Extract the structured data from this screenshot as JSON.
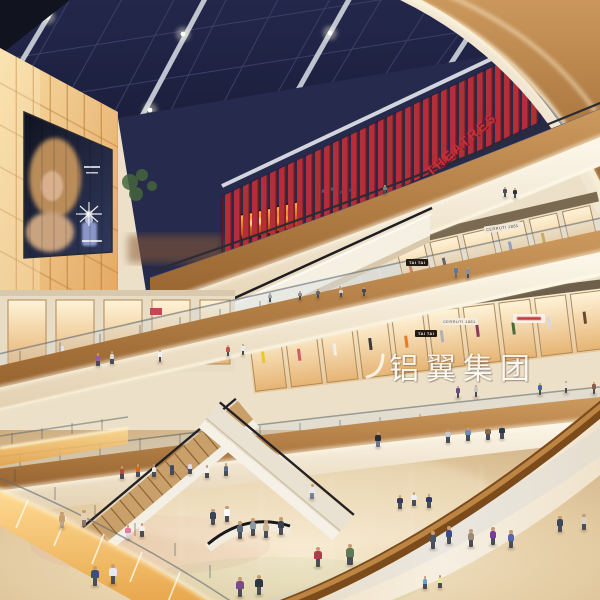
{
  "scene": {
    "description": "Rendering of a multi-level shopping mall atrium: dark skylight grid ceiling, glowing amber light-box wall with perfume billboard, curved cream and wood balconies, red-slat cinema level, escalators, crowded beige marble ground floor",
    "signs": {
      "theatres": "THEATRES",
      "watermark": "铝翼集团",
      "store_cerruti_upper": "CERRUTI 1881",
      "store_cerruti_lower": "CERRUTI 1881",
      "store_taitai_upper": "TAI TAI",
      "store_taitai_lower": "TAI TAI"
    },
    "colors": {
      "ceiling_navy": "#1d2142",
      "beam_white": "#d5dae3",
      "slat_red": "#b22e38",
      "theatres_red": "#c5303c",
      "lightbox_amber": "#f0c080",
      "wood_brown": "#b9854f",
      "cream_white": "#f4ecdd",
      "floor_beige": "#e6d2ab",
      "fire_orange": "#e06a18",
      "handrail_brown": "#9a6428",
      "glass_navy": "#262a4c",
      "tree_green": "#44663c",
      "watermark_white": "#ffffff"
    },
    "people": [
      [
        505,
        197,
        10,
        "#4a4e5e"
      ],
      [
        515,
        198,
        10,
        "#2e3240"
      ],
      [
        385,
        194,
        9,
        "#7a7e8a"
      ],
      [
        270,
        302,
        9,
        "#9aa4ae"
      ],
      [
        300,
        300,
        9,
        "#8a8e9a"
      ],
      [
        318,
        298,
        9,
        "#5a6a7a"
      ],
      [
        341,
        297,
        9,
        "#d0d0d6"
      ],
      [
        364,
        296,
        9,
        "#39495a"
      ],
      [
        456,
        277,
        11,
        "#5a7a9a",
        "#6a7078"
      ],
      [
        468,
        278,
        11,
        "#8090a0"
      ],
      [
        458,
        398,
        12,
        "#6a4a8a"
      ],
      [
        476,
        397,
        12,
        "#c4c6cc"
      ],
      [
        540,
        395,
        12,
        "#46689a"
      ],
      [
        566,
        393,
        12,
        "#e6dfd2"
      ],
      [
        594,
        394,
        12,
        "#8a5a4a"
      ],
      [
        98,
        366,
        13,
        "#9a5aa8"
      ],
      [
        112,
        364,
        13,
        "#d8d8e0"
      ],
      [
        160,
        362,
        12,
        "#f0f0f4"
      ],
      [
        228,
        356,
        11,
        "#c05848"
      ],
      [
        243,
        355,
        11,
        "#e8e8ee"
      ],
      [
        122,
        479,
        13,
        "#b04a3a"
      ],
      [
        138,
        477,
        13,
        "#d2691e"
      ],
      [
        154,
        477,
        13,
        "#e8e8e8"
      ],
      [
        172,
        475,
        13,
        "#3a4a6a"
      ],
      [
        190,
        474,
        13,
        "#dcdce4"
      ],
      [
        207,
        478,
        13,
        "#f4f4f6"
      ],
      [
        226,
        476,
        13,
        "#5a6a8c"
      ],
      [
        62,
        528,
        16,
        "#c8a070",
        "#b8a890"
      ],
      [
        84,
        526,
        16,
        "#e0d0b8",
        "#8a7a6a"
      ],
      [
        312,
        499,
        15,
        "#e8e8ea",
        "#7a8294"
      ],
      [
        128,
        539,
        14,
        "#e87a9a",
        "#d8d8e0"
      ],
      [
        142,
        537,
        14,
        "#f0f0f4"
      ],
      [
        95,
        586,
        20,
        "#38507c"
      ],
      [
        113,
        584,
        20,
        "#e8e8f0"
      ],
      [
        213,
        525,
        16,
        "#3a4458"
      ],
      [
        227,
        522,
        16,
        "#fcfcfc"
      ],
      [
        240,
        539,
        18,
        "#5a6878"
      ],
      [
        253,
        536,
        18,
        "#8a9aa8"
      ],
      [
        266,
        538,
        18,
        "#c8b89a"
      ],
      [
        281,
        535,
        18,
        "#39424e"
      ],
      [
        318,
        567,
        20,
        "#b03a4a"
      ],
      [
        350,
        565,
        21,
        "#5f7a52"
      ],
      [
        400,
        509,
        14,
        "#3a3a5a"
      ],
      [
        414,
        506,
        14,
        "#eeeef2"
      ],
      [
        429,
        508,
        14,
        "#2a3a6a"
      ],
      [
        433,
        549,
        18,
        "#46566a"
      ],
      [
        449,
        544,
        18,
        "#3a4a8c"
      ],
      [
        471,
        547,
        18,
        "#9a8a78"
      ],
      [
        493,
        545,
        18,
        "#7a3aa0"
      ],
      [
        511,
        548,
        18,
        "#5566aa"
      ],
      [
        240,
        597,
        20,
        "#7a4a8a"
      ],
      [
        259,
        595,
        20,
        "#2e3440"
      ],
      [
        560,
        532,
        16,
        "#3a4a5a"
      ],
      [
        584,
        530,
        16,
        "#d8d0c0"
      ],
      [
        425,
        589,
        13,
        "#6aa0c8"
      ],
      [
        440,
        588,
        13,
        "#e8e890"
      ],
      [
        378,
        447,
        15,
        "#2a2a34",
        "#6a7890"
      ],
      [
        448,
        443,
        14,
        "#c8c8d0"
      ],
      [
        468,
        441,
        14,
        "#6a90b8"
      ],
      [
        488,
        440,
        14,
        "#8a6a4a"
      ],
      [
        502,
        439,
        14,
        "#2a3a4a"
      ]
    ]
  }
}
